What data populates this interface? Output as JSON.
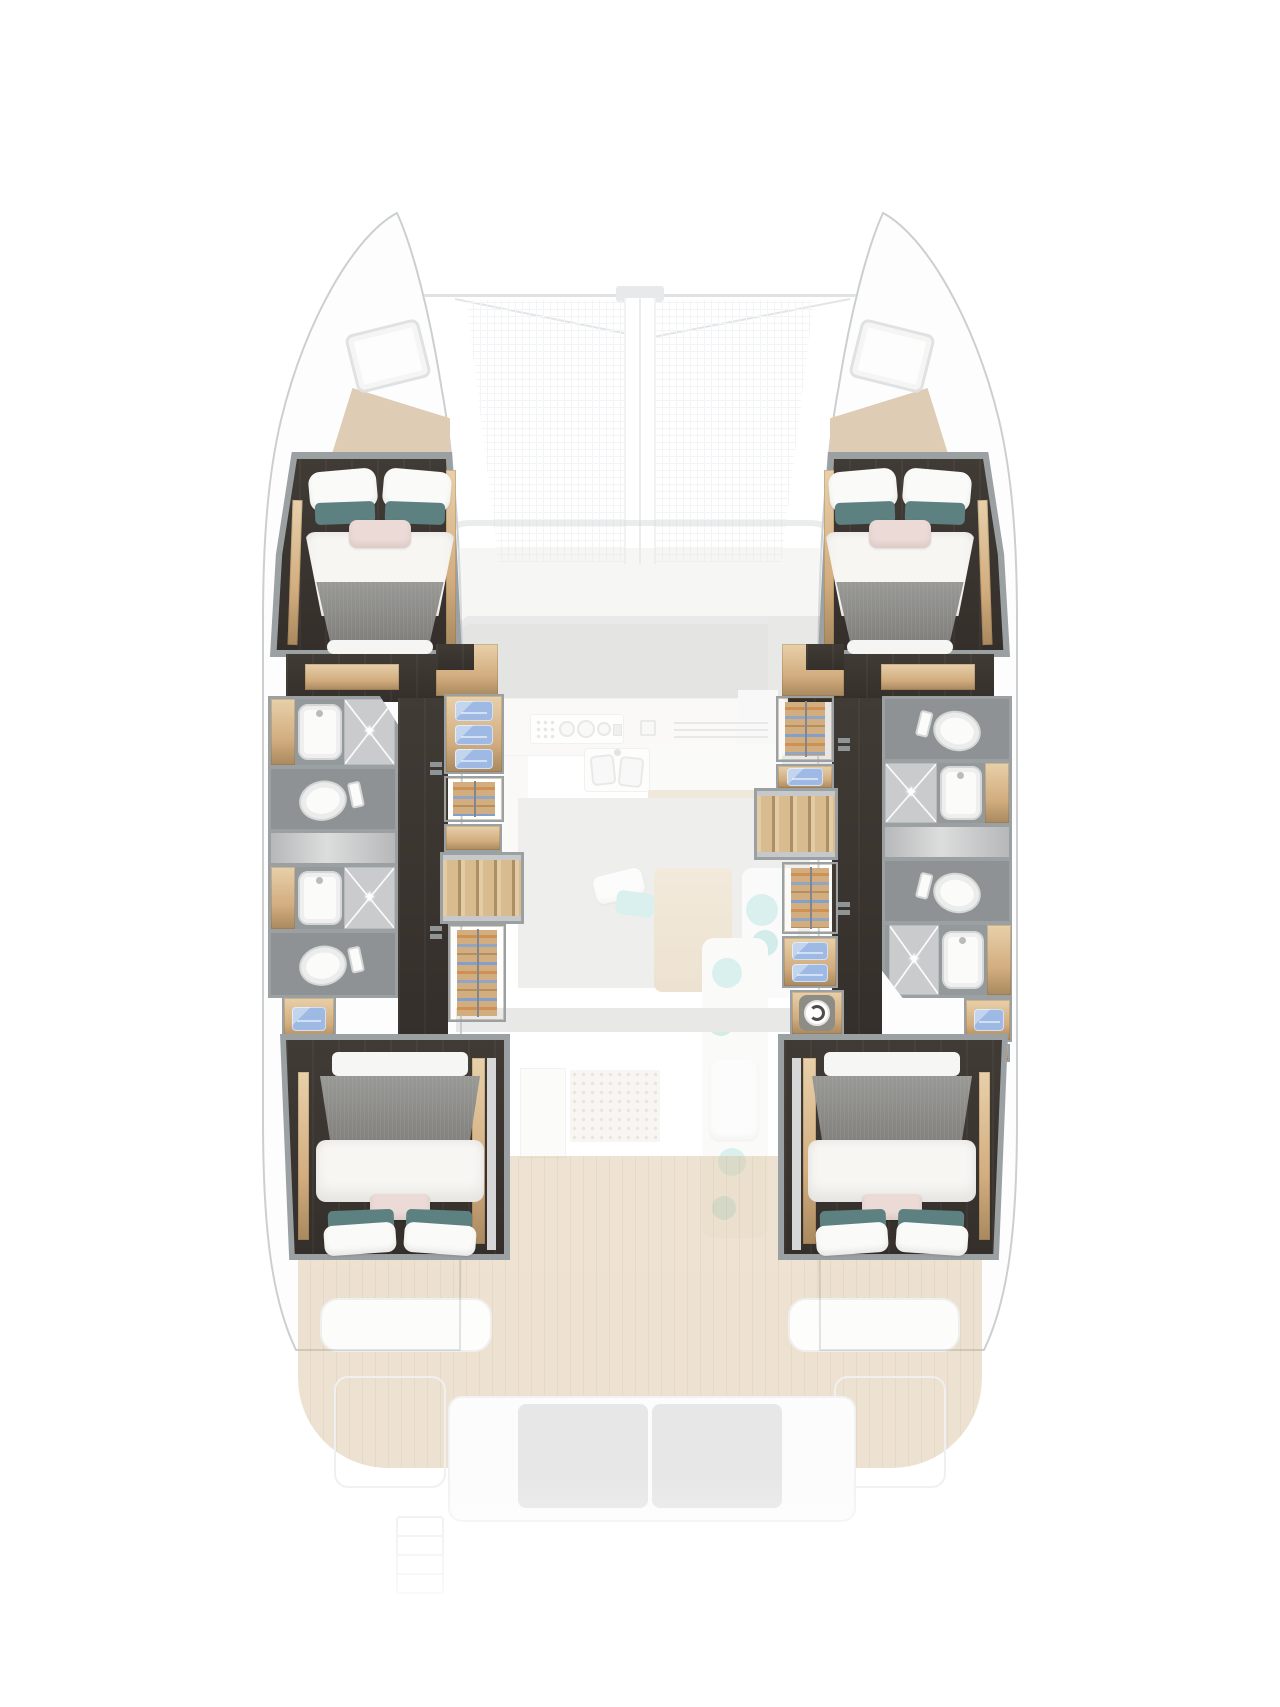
{
  "palette": {
    "frame": "#9ba0a3",
    "frame-light": "#dfe1e2",
    "floor-a": "#413b36",
    "floor-b": "#352f2b",
    "wood": "#d2ad7f",
    "wood-light": "#e8d0aa",
    "wood-dark": "#a9895f",
    "step": "#ddc49c",
    "bath-wall": "#94999c",
    "bath-floor": "#c9cbcc",
    "wc-floor": "#8e9295",
    "fixture-white": "#fbfbfa",
    "fixture-line": "#d5d7d7",
    "towel": "#9db9e4",
    "towel-light": "#c3d4ee",
    "mattress-a": "#999996",
    "mattress-b": "#807f7c",
    "duvet": "#f7f6f3",
    "pillow-white": "#fafaf8",
    "pillow-teal": "#5d8081",
    "pillow-blush": "#ecdad6",
    "mint": "#a5dcd7",
    "sofa-grey": "#bcbdbb",
    "rug": "#d5d5d3",
    "teak": "#d9c09a",
    "teak-line": "#c8ad83",
    "hull-line": "#9aa0a3",
    "net": "#e9ebed"
  },
  "plan": {
    "vessel": "catamaran",
    "view": "top-down interior deck plan",
    "hulls": {
      "port": [
        "forward-double-cabin",
        "bathroom-sink-shower",
        "wc",
        "bathroom-sink-shower",
        "wc",
        "towel-shelves",
        "wardrobe",
        "staircase",
        "aft-double-cabin"
      ],
      "starboard": [
        "forward-double-cabin",
        "wc",
        "bathroom-shower-sink",
        "wc",
        "bathroom-shower-sink",
        "wardrobe",
        "towel-shelves",
        "staircase",
        "washing-machine",
        "aft-double-cabin"
      ]
    },
    "main_deck_faded": [
      "bow-trampoline",
      "anchor-fitting",
      "bow-hatches",
      "salon-sofa",
      "chaise-cyan-pillows",
      "galley-counter",
      "stove",
      "double-sink",
      "rug",
      "dinette-table",
      "lounge-mint-cushions",
      "companionway-mat",
      "cockpit-benches",
      "aft-sofa",
      "teak-deck",
      "transom-steps"
    ],
    "counts": {
      "cabins": 4,
      "shower-rooms": 4,
      "wc": 4,
      "staircases": 2,
      "washing-machines": 1
    }
  },
  "icons": {
    "shower-sparkle": "sparkle-icon",
    "washing-machine": "washer-drum-icon",
    "toilet": "toilet-top-view-icon",
    "sink": "basin-top-view-icon"
  }
}
